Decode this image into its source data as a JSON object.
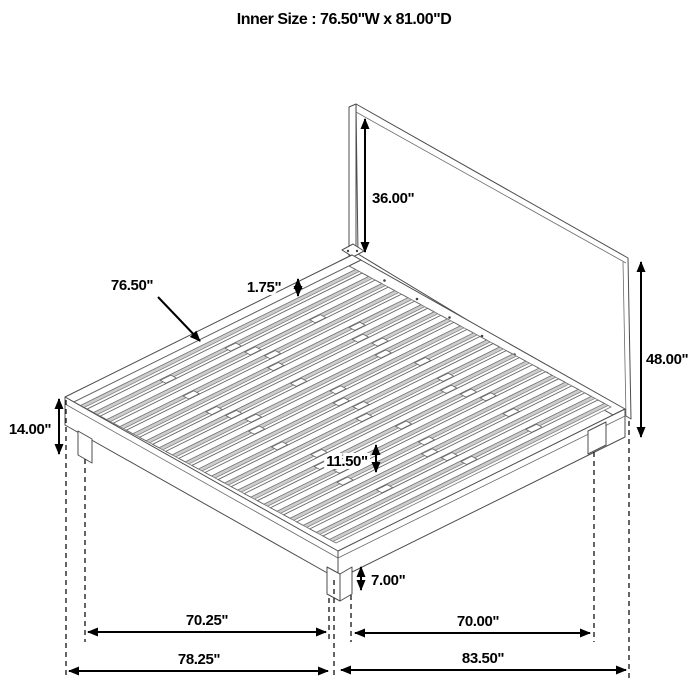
{
  "title": "Inner Size : 76.50\"W x 81.00\"D",
  "diagram": {
    "type": "isometric bed frame dimension drawing",
    "dims": {
      "headboard_panel_height": "36.00\"",
      "slat_length": "76.50\"",
      "slat_thickness": "1.75\"",
      "headboard_total_height": "48.00\"",
      "platform_height": "14.00\"",
      "slat_spacing": "11.50\"",
      "leg_height": "7.00\"",
      "front_leg_span": "70.25\"",
      "side_leg_span": "70.00\"",
      "front_overall_width": "78.25\"",
      "side_overall_depth": "83.50\""
    }
  }
}
